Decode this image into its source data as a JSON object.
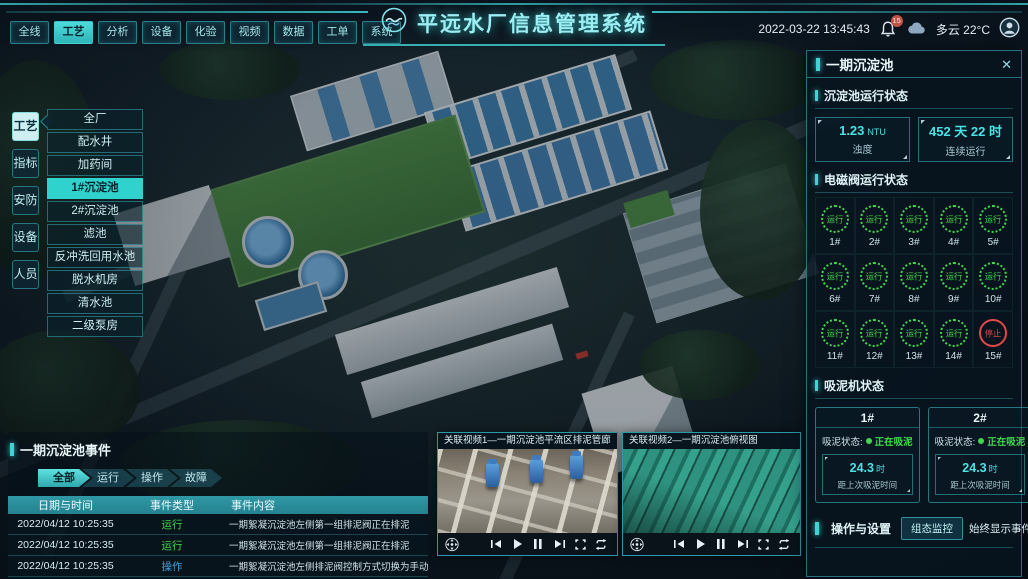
{
  "header": {
    "title": "平远水厂信息管理系统",
    "datetime": "2022-03-22 13:45:43",
    "weather": "多云 22°C",
    "notification_count": "15",
    "nav_tabs": [
      {
        "label": "全线",
        "state": ""
      },
      {
        "label": "工艺",
        "state": "active"
      },
      {
        "label": "分析",
        "state": ""
      },
      {
        "label": "设备",
        "state": ""
      },
      {
        "label": "化验",
        "state": ""
      },
      {
        "label": "视频",
        "state": ""
      },
      {
        "label": "数据",
        "state": ""
      },
      {
        "label": "工单",
        "state": ""
      },
      {
        "label": "系统",
        "state": ""
      }
    ]
  },
  "sidebar": {
    "tabs": [
      {
        "label": "工艺",
        "state": "active"
      },
      {
        "label": "指标",
        "state": ""
      },
      {
        "label": "安防",
        "state": ""
      },
      {
        "label": "设备",
        "state": ""
      },
      {
        "label": "人员",
        "state": ""
      }
    ],
    "menu": [
      {
        "label": "全厂",
        "state": ""
      },
      {
        "label": "配水井",
        "state": ""
      },
      {
        "label": "加药间",
        "state": ""
      },
      {
        "label": "1#沉淀池",
        "state": "active"
      },
      {
        "label": "2#沉淀池",
        "state": ""
      },
      {
        "label": "滤池",
        "state": ""
      },
      {
        "label": "反冲洗回用水池",
        "state": ""
      },
      {
        "label": "脱水机房",
        "state": ""
      },
      {
        "label": "清水池",
        "state": ""
      },
      {
        "label": "二级泵房",
        "state": ""
      }
    ]
  },
  "right_panel": {
    "title": "一期沉淀池",
    "close_label": "✕",
    "run_status": {
      "title": "沉淀池运行状态",
      "stats": [
        {
          "value": "1.23",
          "unit": "NTU",
          "label": "浊度"
        },
        {
          "value": "452 天 22 时",
          "unit": "",
          "label": "连续运行"
        }
      ]
    },
    "valves": {
      "title": "电磁阀运行状态",
      "items": [
        {
          "id": "1#",
          "status": "运行",
          "state": "run"
        },
        {
          "id": "2#",
          "status": "运行",
          "state": "run"
        },
        {
          "id": "3#",
          "status": "运行",
          "state": "run"
        },
        {
          "id": "4#",
          "status": "运行",
          "state": "run"
        },
        {
          "id": "5#",
          "status": "运行",
          "state": "run"
        },
        {
          "id": "6#",
          "status": "运行",
          "state": "run"
        },
        {
          "id": "7#",
          "status": "运行",
          "state": "run"
        },
        {
          "id": "8#",
          "status": "运行",
          "state": "run"
        },
        {
          "id": "9#",
          "status": "运行",
          "state": "run"
        },
        {
          "id": "10#",
          "status": "运行",
          "state": "run"
        },
        {
          "id": "11#",
          "status": "运行",
          "state": "run"
        },
        {
          "id": "12#",
          "status": "运行",
          "state": "run"
        },
        {
          "id": "13#",
          "status": "运行",
          "state": "run"
        },
        {
          "id": "14#",
          "status": "运行",
          "state": "run"
        },
        {
          "id": "15#",
          "status": "停止",
          "state": "stop"
        }
      ]
    },
    "mud_machines": {
      "title": "吸泥机状态",
      "status_label": "吸泥状态:",
      "machines": [
        {
          "id": "1#",
          "status": "正在吸泥",
          "value": "24.3",
          "unit": "时",
          "label": "距上次吸泥时间"
        },
        {
          "id": "2#",
          "status": "正在吸泥",
          "value": "24.3",
          "unit": "时",
          "label": "距上次吸泥时间"
        }
      ]
    },
    "operations": {
      "title": "操作与设置",
      "monitor_button": "组态监控",
      "toggle_label": "始终显示事件:",
      "toggle_state": "on"
    }
  },
  "events": {
    "title": "一期沉淀池事件",
    "tabs": [
      {
        "label": "全部",
        "state": "active"
      },
      {
        "label": "运行",
        "state": ""
      },
      {
        "label": "操作",
        "state": ""
      },
      {
        "label": "故障",
        "state": ""
      }
    ],
    "columns": [
      "日期与时间",
      "事件类型",
      "事件内容"
    ],
    "rows": [
      {
        "time": "2022/04/12 10:25:35",
        "type": "运行",
        "state": "run",
        "content": "一期絮凝沉淀池左侧第一组排泥阀正在排泥"
      },
      {
        "time": "2022/04/12 10:25:35",
        "type": "运行",
        "state": "run",
        "content": "一期絮凝沉淀池左侧第一组排泥阀正在排泥"
      },
      {
        "time": "2022/04/12 10:25:35",
        "type": "操作",
        "state": "op",
        "content": "一期絮凝沉淀池左侧排泥阀控制方式切换为手动"
      },
      {
        "time": "2022/04/12 10:25:35",
        "type": "故障",
        "state": "fault",
        "content": "一期絮凝沉淀池左侧第二组排泥阀启动失败"
      }
    ]
  },
  "videos": [
    {
      "title": "关联视频1—一期沉淀池平流区排泥管廊"
    },
    {
      "title": "关联视频2—一期沉淀池俯视图"
    }
  ],
  "colors": {
    "accent": "#3fd4d4",
    "green": "#42d84e",
    "red": "#e14848",
    "blue": "#3f9fe0"
  }
}
